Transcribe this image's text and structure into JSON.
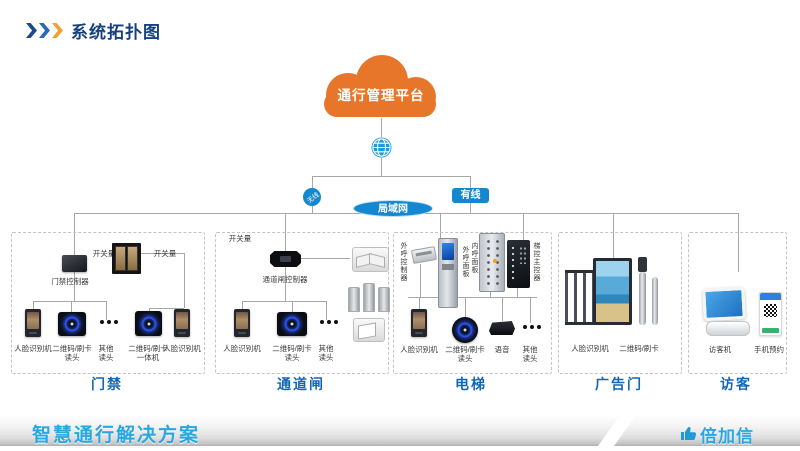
{
  "header": {
    "title": "系统拓扑图"
  },
  "platform": {
    "cloud_label": "通行管理平台"
  },
  "network": {
    "wireless_label": "无线",
    "wired_label": "有线",
    "lan_label": "局域网"
  },
  "groups": [
    {
      "caption": "门禁",
      "signal_left": "开关量",
      "signal_right": "开关量",
      "controller": "门禁控制器",
      "devices": [
        {
          "label": "人脸识别机"
        },
        {
          "line1": "二维码/刷卡",
          "line2": "读头"
        },
        {
          "line1": "其他",
          "line2": "读头"
        },
        {
          "line1": "二维码/刷卡",
          "line2": "一体机"
        },
        {
          "label": "人脸识别机"
        }
      ]
    },
    {
      "caption": "通道闸",
      "signal": "开关量",
      "controller": "通道闸控制器",
      "devices": [
        {
          "label": "人脸识别机"
        },
        {
          "line1": "二维码/刷卡",
          "line2": "读头"
        },
        {
          "line1": "其他",
          "line2": "读头"
        }
      ]
    },
    {
      "caption": "电梯",
      "panels": [
        {
          "label": "外呼控制器"
        },
        {
          "label": "外呼面板"
        },
        {
          "label": "内呼面板"
        },
        {
          "label": "梯控主控器"
        }
      ],
      "devices": [
        {
          "label": "人脸识别机"
        },
        {
          "line1": "二维码/刷卡",
          "line2": "读头"
        },
        {
          "label": "语音"
        },
        {
          "line1": "其他",
          "line2": "读头"
        }
      ]
    },
    {
      "caption": "广告门",
      "devices": [
        {
          "label": "人脸识别机"
        },
        {
          "label": "二维码/刷卡"
        }
      ]
    },
    {
      "caption": "访客",
      "devices": [
        {
          "label": "访客机"
        },
        {
          "label": "手机预约"
        }
      ]
    }
  ],
  "footer": {
    "solution": "智慧通行解决方案",
    "brand": "倍加信"
  },
  "colors": {
    "accent_blue": "#1387d0",
    "cloud_orange": "#e8762a",
    "title_navy": "#16417e",
    "caption_blue": "#1467b8",
    "footer_text_blue": "#29a7e0",
    "chevron_orange": "#f0a030"
  }
}
